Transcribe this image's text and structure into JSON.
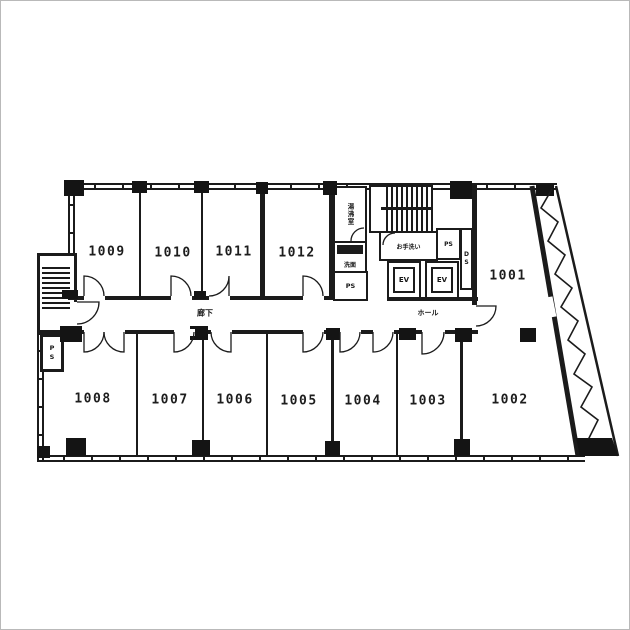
{
  "colors": {
    "ink": "#1b1b1b",
    "paper": "#ffffff"
  },
  "rooms": {
    "r1009": "1009",
    "r1010": "1010",
    "r1011": "1011",
    "r1012": "1012",
    "r1001": "1001",
    "r1002": "1002",
    "r1003": "1003",
    "r1004": "1004",
    "r1005": "1005",
    "r1006": "1006",
    "r1007": "1007",
    "r1008": "1008"
  },
  "labels": {
    "corridor": "廊下",
    "hall": "ホール",
    "elevator_1": "EV",
    "elevator_2": "EV",
    "pipe_shaft_core": "PS",
    "pipe_shaft_upper": "PS",
    "pipe_shaft_left": "PS",
    "duct_shaft": "DS",
    "kitchenette": "湯沸室",
    "toilet": "お手洗い",
    "washstand": "洗面"
  }
}
